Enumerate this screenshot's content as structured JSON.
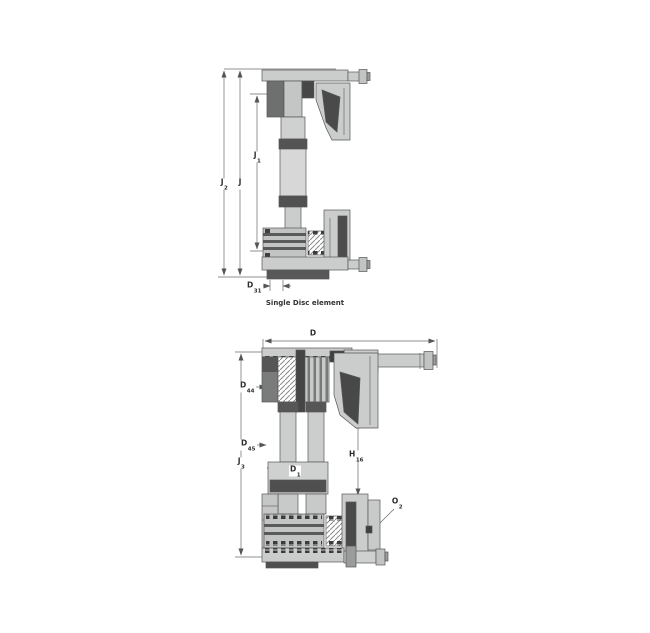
{
  "colors": {
    "outline": "#565656",
    "light_gray": "#cbcdcc",
    "mid_gray": "#9a9c9b",
    "dark_gray": "#4f4f4f",
    "darker_gray": "#3c3c3c",
    "dim_line": "#6a6a6a",
    "text": "#2d2d2d",
    "background": "#ffffff"
  },
  "top": {
    "caption": "Single Disc element",
    "dims": {
      "j2": {
        "base": "J",
        "sub": "2"
      },
      "j": {
        "base": "J",
        "sub": ""
      },
      "j1": {
        "base": "J",
        "sub": "1"
      },
      "d31": {
        "base": "D",
        "sub": "31"
      }
    }
  },
  "bottom": {
    "dims": {
      "d": {
        "base": "D",
        "sub": ""
      },
      "j3": {
        "base": "J",
        "sub": "3"
      },
      "d44": {
        "base": "D",
        "sub": "44"
      },
      "d45": {
        "base": "D",
        "sub": "45"
      },
      "d1": {
        "base": "D",
        "sub": "1"
      },
      "h16": {
        "base": "H",
        "sub": "16"
      },
      "o2": {
        "base": "O",
        "sub": "2"
      }
    }
  }
}
